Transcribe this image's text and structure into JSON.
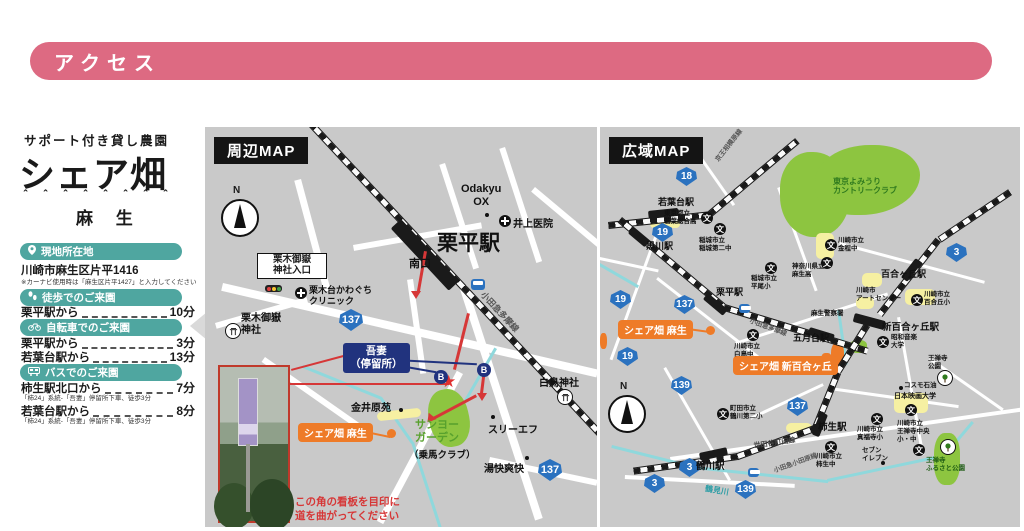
{
  "header": {
    "title": "アクセス"
  },
  "brand": {
    "tagline": "サポート付き貸し農園",
    "name": "シェア畑",
    "decoration": "＾＾＾＾＾＾＾＾",
    "location": "麻 生"
  },
  "access": {
    "address": {
      "heading": "現地所在地",
      "value": "川崎市麻生区片平1416",
      "note": "※カーナビ使用時は「麻生区片平1427」と入力してください"
    },
    "walk": {
      "heading": "徒歩でのご来園",
      "rows": [
        {
          "from": "栗平駅から",
          "time": "10分"
        }
      ]
    },
    "bicycle": {
      "heading": "自転車でのご来園",
      "rows": [
        {
          "from": "栗平駅から",
          "time": "3分"
        },
        {
          "from": "若葉台駅から",
          "time": "13分"
        }
      ]
    },
    "bus": {
      "heading": "バスでのご来園",
      "rows": [
        {
          "from": "柿生駅北口から",
          "time": "7分",
          "note": "「柿24」系統-「吾妻」停留所下車、徒歩3分"
        },
        {
          "from": "若葉台駅から",
          "time": "8分",
          "note": "「柿24」系統-「吾妻」停留所下車、徒歩3分"
        }
      ]
    }
  },
  "map_local": {
    "title": "周辺MAP",
    "compass_label": "N",
    "labels": {
      "intersection": "栗木御嶽\n神社入口",
      "odakyu_ox": "Odakyu\nOX",
      "inoue_clinic": "井上医院",
      "kurihira_station": "栗平駅",
      "south_exit": "南口",
      "odakyu_tama_line": "小田急多摩線",
      "kawaguchi_clinic": "栗木台かわぐち\nクリニック",
      "mitake_shrine": "栗木御嶽\n神社",
      "azuma_stop": "吾妻\n（停留所）",
      "kanaibara_en": "金井原苑",
      "sharefarm_asao": "シェア畑 麻生",
      "sanyo_garden": "サンヨー\nガーデン",
      "sanyo_garden_sub": "（乗馬クラブ）",
      "three_f": "スリーエフ",
      "shiratori_shrine": "白鳥神社",
      "yukai_sokai": "湯快爽快",
      "route_137": "137",
      "bus_stop_glyph": "B",
      "star_glyph": "★",
      "signboard_note": "この角の看板を目印に\n道を曲がってください"
    }
  },
  "map_wide": {
    "title": "広域MAP",
    "compass_label": "N",
    "stations": {
      "wakabadai": "若葉台駅",
      "kurokawa": "黒川駅",
      "kurihira": "栗平駅",
      "satsukidai": "五月台駅",
      "shin_yurigaoka": "新百合ヶ丘駅",
      "yurigaoka": "百合ヶ丘駅",
      "kakio": "柿生駅",
      "tsurukawa": "鶴川駅"
    },
    "railways": {
      "keio_sagamihara": "京王相模原線",
      "odakyu_tama": "小田急多摩線",
      "odakyu_odawara": "小田急小田原線"
    },
    "roads": {
      "setagaya_machida": "世田谷町田線"
    },
    "route_shields": {
      "r18": "18",
      "r19": "19",
      "r3": "3",
      "r137": "137",
      "r139": "139"
    },
    "pois": {
      "yomiuri_country_club": "東京よみうり\nカントリークラブ",
      "wakaba_sogo_hs": "東京都立\n若葉総合高",
      "inagi_daini_jhs": "稲城市立\n稲城第二中",
      "hirao_es": "稲城市立\n平尾小",
      "kanahodo_jhs": "川崎市立\n金程中",
      "asao_hs": "神奈川県立\n麻生高",
      "asao_police": "麻生警察署",
      "shiratori_jhs": "川崎市立\n白鳥中",
      "art_center": "川崎市\nアートセンター",
      "showa_music_univ": "昭和音楽\n大学",
      "yurigaoka_es": "川崎市立\n百合丘小",
      "ozenji_park": "王禅寺\n公園",
      "cosmo_oil": "コスモ石油",
      "nihon_eiga_univ": "日本映画大学",
      "tsurukawa_daini_es": "町田市立\n鶴川第二小",
      "shinpukuji_es": "川崎市立\n真福寺小",
      "ozenji_chuo_school": "川崎市立\n王禅寺中央\n小・中",
      "kakio_jhs": "川崎市立\n柿生中",
      "seven_eleven": "セブン\nイレブン",
      "ozenji_furusato_park": "王禅寺\nふるさと公園",
      "tsurumi_river": "鶴見川"
    },
    "sharefarm": {
      "asao": "シェア畑 麻生",
      "shin_yurigaoka": "シェア畑 新百合ヶ丘"
    },
    "school_icon_glyph": "文"
  },
  "colors": {
    "accent_pink": "#dd6a82",
    "teal": "#4fa6a0",
    "navy": "#21337e",
    "orange": "#ee7b28",
    "route_blue": "#2b72bf",
    "map_gray": "#c9c9c9",
    "green": "#8dc540",
    "river": "#8fd8dc",
    "red": "#d63737"
  }
}
